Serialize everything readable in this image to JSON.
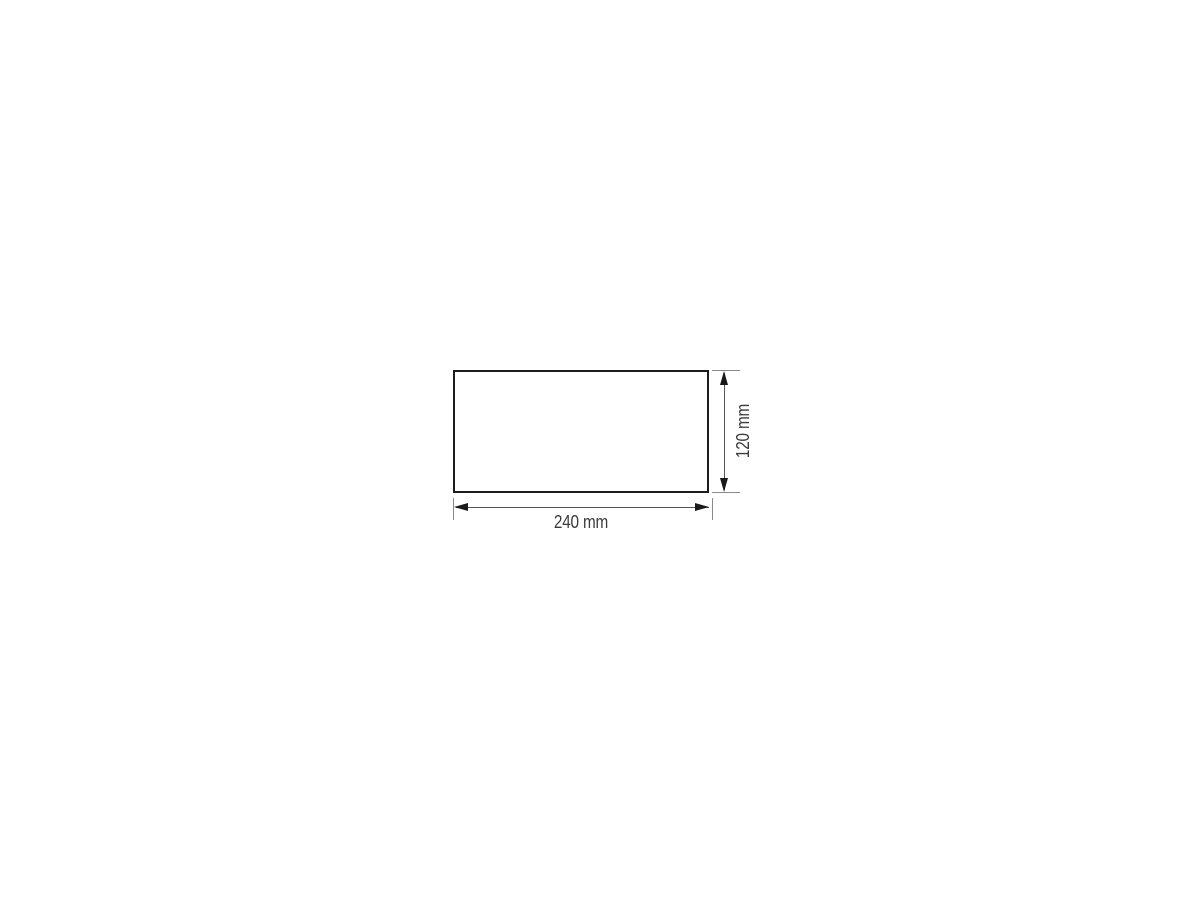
{
  "drawing": {
    "name": "product-dimension-drawing",
    "shape": "rectangle",
    "dimensions": {
      "width": {
        "label": "240 mm",
        "value": 240,
        "unit": "mm"
      },
      "height": {
        "label": "120 mm",
        "value": 120,
        "unit": "mm"
      }
    },
    "colors": {
      "outline": "#1c1c1c",
      "dimension_line": "#555555",
      "extension_line": "#8a8a8a",
      "arrow": "#1a1a1a",
      "label_text": "#3b3b3b",
      "background": "#ffffff"
    }
  }
}
